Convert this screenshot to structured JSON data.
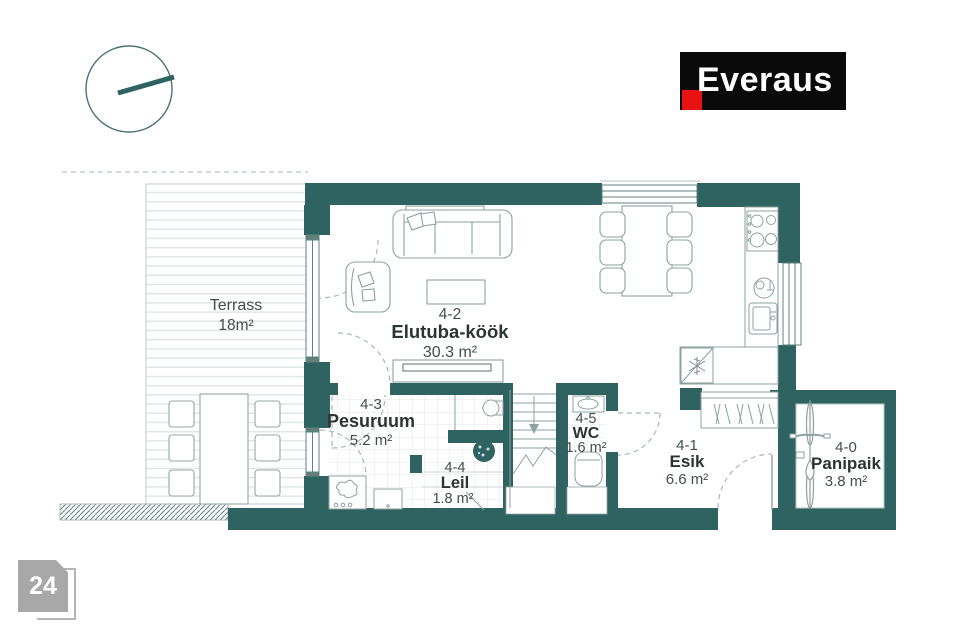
{
  "header": {
    "brand": "Everaus"
  },
  "page_badge": {
    "number": "24"
  },
  "plan": {
    "colors": {
      "wall_teal": "#2e6361",
      "logo_background": "#0a0a0a",
      "logo_red": "#e81212",
      "badge_gray": "#a8a8a8"
    },
    "rooms": {
      "terrass": {
        "number": "",
        "name": "Terrass",
        "area": "18m²"
      },
      "elutuba": {
        "number": "4-2",
        "name": "Elutuba-köök",
        "area": "30.3 m²"
      },
      "pesuruum": {
        "number": "4-3",
        "name": "Pesuruum",
        "area": "5.2 m²"
      },
      "leil": {
        "number": "4-4",
        "name": "Leil",
        "area": "1.8 m²"
      },
      "wc": {
        "number": "4-5",
        "name": "WC",
        "area": "1.6 m²"
      },
      "esik": {
        "number": "4-1",
        "name": "Esik",
        "area": "6.6 m²"
      },
      "panipaik": {
        "number": "4-0",
        "name": "Panipaik",
        "area": "3.8 m²"
      }
    }
  }
}
